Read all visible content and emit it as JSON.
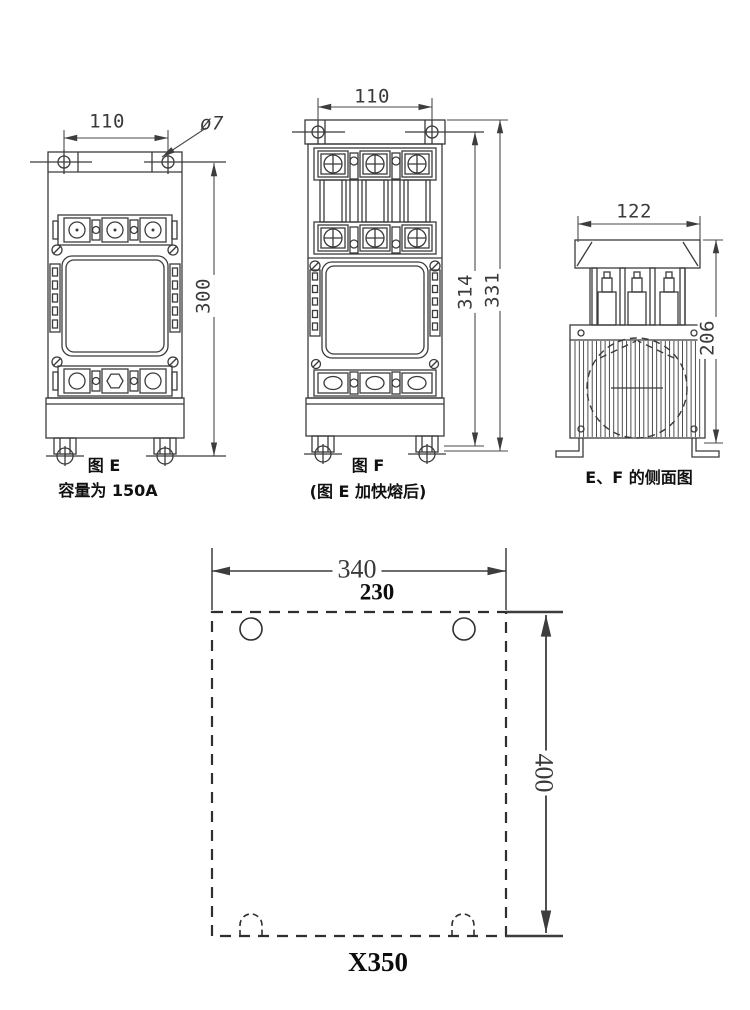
{
  "figures": {
    "fig_e": {
      "label": "图 E",
      "caption": "容量为 150A",
      "dim_width": "110",
      "dim_hole": "ø7",
      "dim_height": "300"
    },
    "fig_f": {
      "label": "图 F",
      "caption": "(图 E 加快熔后)",
      "dim_width": "110",
      "dim_height_inner": "314",
      "dim_height_outer": "331"
    },
    "side_view": {
      "label": "E、F 的侧面图",
      "dim_width": "122",
      "dim_height": "206"
    },
    "mounting_plate": {
      "label": "X350",
      "dim_width_outer": "340",
      "dim_width_inner": "230",
      "dim_height": "400"
    }
  },
  "colors": {
    "line": "#3b3b3b",
    "dim_line": "#4a4a4a",
    "plate_line": "#2f2f2f",
    "text": "#111111",
    "background": "#ffffff"
  }
}
